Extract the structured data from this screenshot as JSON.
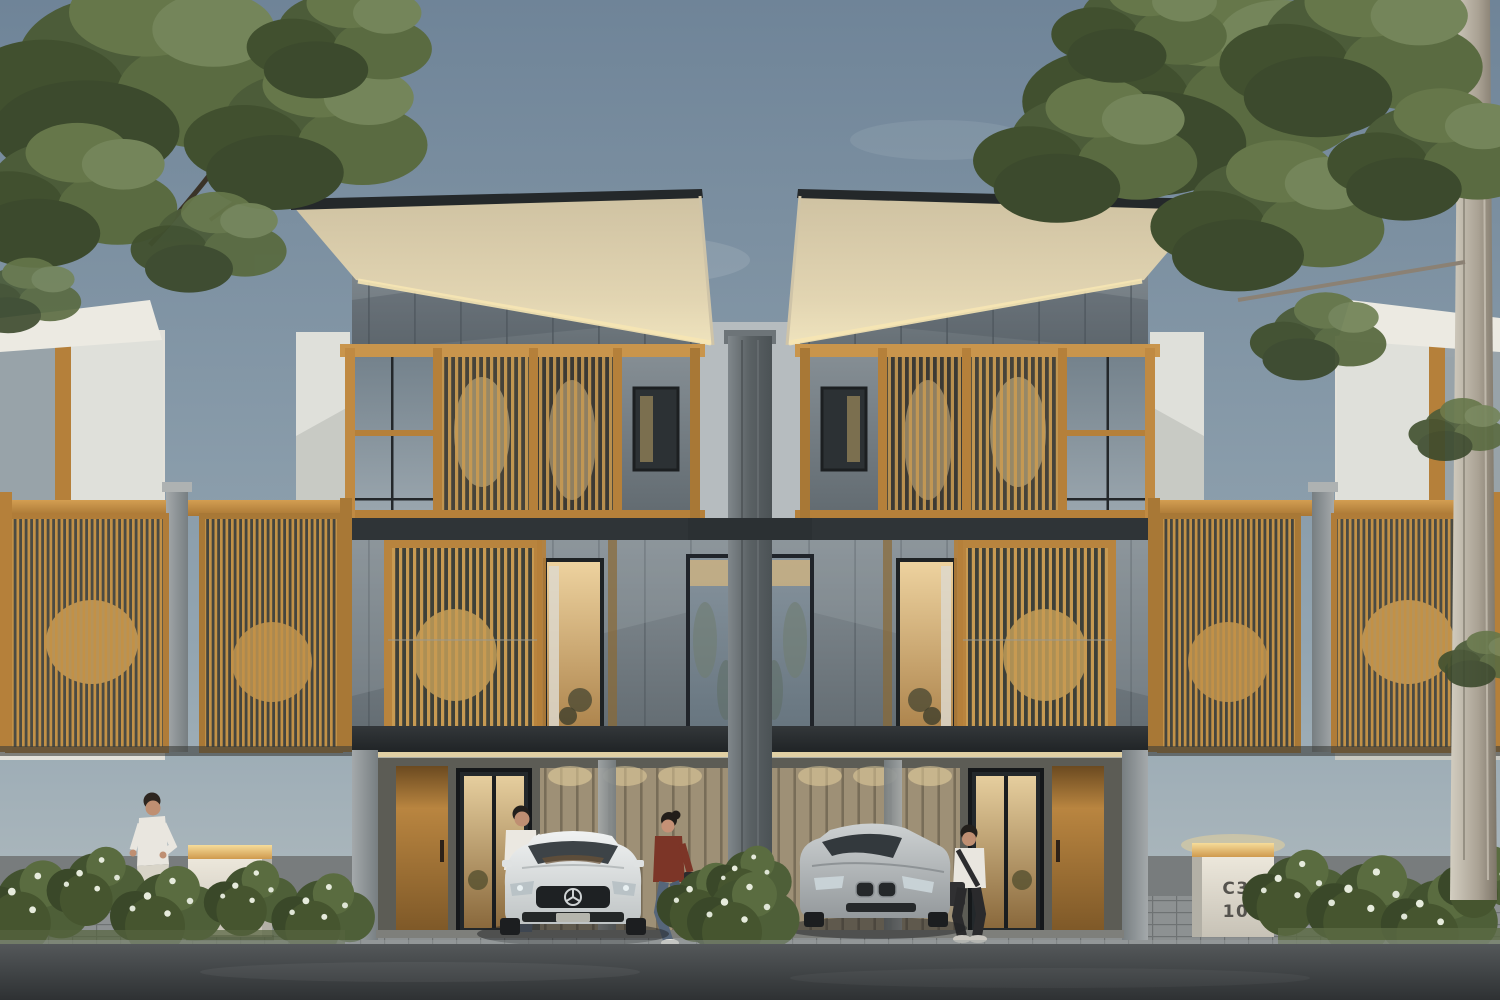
{
  "scene": {
    "title": "Modern duplex townhouse exterior rendering at dusk",
    "setting": "two mirrored three-storey townhouses with timber slat screens, cantilevered roofs, carports with parked sedans, street and planting in foreground",
    "units": [
      {
        "id": "C3 11",
        "position": "left",
        "car": "white sedan"
      },
      {
        "id": "C3 10",
        "position": "right",
        "car": "silver sedan"
      }
    ],
    "people": [
      "jogger-on-sidewalk",
      "man-beside-white-car",
      "woman-walking-with-bag",
      "man-leaning-by-silver-car"
    ],
    "vegetation": [
      "large-tree-top-left",
      "large-tree-right-with-trunk",
      "flowering-hedges-along-street"
    ]
  },
  "signs": {
    "left": {
      "line1": "C3",
      "line2": "11"
    },
    "right": {
      "line1": "C3",
      "line2": "10"
    }
  },
  "colors": {
    "sky_top": "#6f8498",
    "sky_bottom": "#b7c0c2",
    "roof_underside": "#e2d5b2",
    "warm_light": "#f0d49a",
    "timber": "#c79a52",
    "timber_dark": "#7c5727",
    "wall_gray": "#7c858b",
    "wall_white": "#e4e2da",
    "concrete": "#9aa0a2",
    "asphalt": "#33373a",
    "foliage": "#4e5d3b",
    "sign_body": "#e7e2d6",
    "sign_text": "#4e4e48"
  }
}
